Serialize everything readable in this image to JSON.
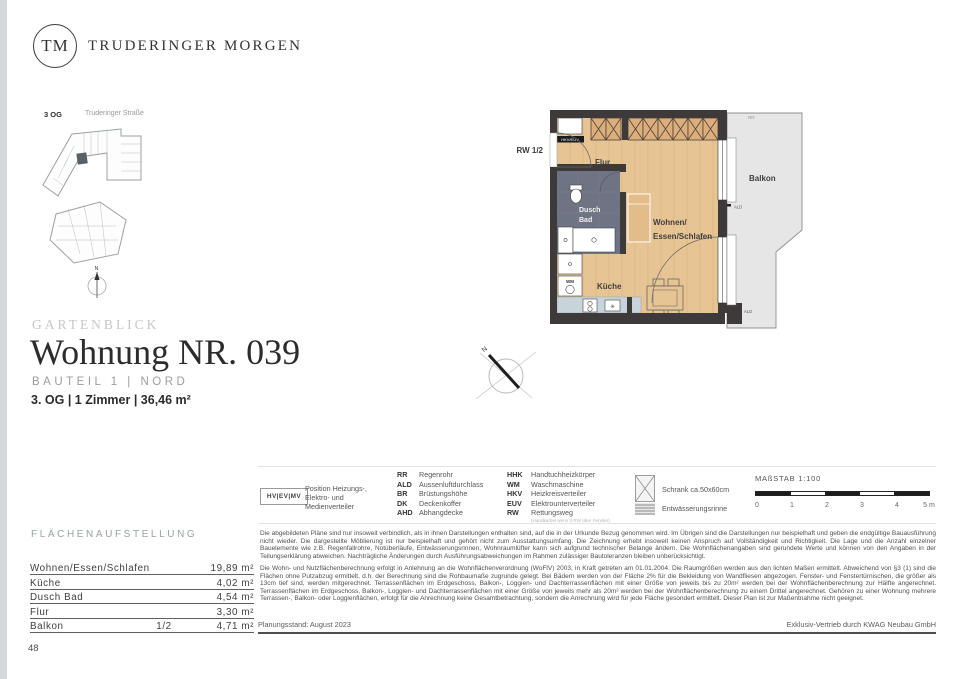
{
  "brand": {
    "initials": "TM",
    "name": "TRUDERINGER MORGEN"
  },
  "site_plan": {
    "floor": "3 OG",
    "street": "Truderinger Straße",
    "north": "N"
  },
  "floor_plan": {
    "rw": "RW 1/2",
    "flur": "Flur",
    "dusch": "Dusch",
    "bad": "Bad",
    "wohnen1": "Wohnen/",
    "wohnen2": "Essen/Schlafen",
    "kueche": "Küche",
    "balkon": "Balkon",
    "wm": "WM",
    "hkveuv": "HKV/EUV",
    "rr": "RR",
    "ald_top": "ALD",
    "ald_bottom": "ALD",
    "north": "N"
  },
  "title_block": {
    "project": "GARTENBLICK",
    "title": "Wohnung NR. 039",
    "subtitle": "BAUTEIL 1 | NORD",
    "details": "3. OG | 1 Zimmer | 36,46 m²"
  },
  "legend": {
    "hvevmv": "HV|EV|MV",
    "hvevmv_desc": "Position Heizungs-, Elektro- und Medienverteiler",
    "col1": [
      {
        "abbr": "RR",
        "label": "Regenrohr"
      },
      {
        "abbr": "ALD",
        "label": "Aussenluftdurchlass"
      },
      {
        "abbr": "BR",
        "label": "Brüstungshöhe"
      },
      {
        "abbr": "DK",
        "label": "Deckenkoffer"
      },
      {
        "abbr": "AHD",
        "label": "Abhangdecke"
      }
    ],
    "col2": [
      {
        "abbr": "HHK",
        "label": "Handtuchheizkörper"
      },
      {
        "abbr": "WM",
        "label": "Waschmaschine"
      },
      {
        "abbr": "HKV",
        "label": "Heizkreisverteiler"
      },
      {
        "abbr": "EUV",
        "label": "Elektrounterverteiler"
      },
      {
        "abbr": "RW",
        "label": "Rettungsweg",
        "note": "(Handkurbel wenn 2.RW über Fenster)"
      }
    ],
    "schrank": "Schrank ca.50x60cm",
    "rinne": "Entwässerungsrinne",
    "scale": {
      "title": "MAßSTAB 1:100",
      "ticks": [
        "0",
        "1",
        "2",
        "3",
        "4",
        "5 m"
      ]
    }
  },
  "disclaimer": {
    "p1": "Die abgebildeten Pläne sind nur insoweit verbindlich, als in ihnen Darstellungen enthalten sind, auf die in der Urkunde Bezug genommen wird. Im Übrigen sind die Darstellungen nur beispielhaft und geben die endgültige Bauausführung nicht wieder. Die dargestellte Möblierung ist nur beispielhaft und gehört nicht zum Ausstattungsumfang. Die Zeichnung erhebt insoweit keinen Anspruch auf Vollständigkeit und Richtigkeit. Die Lage und die Anzahl einzelner Bauelemente wie z.B. Regenfallrohre, Notüberläufe, Entwässerungsrinnen, Wohnraumlüfter kann sich aufgrund technischer Belange ändern. Die Wohnflächenangaben sind gerundete Werte und können von den Angaben in der Teilungserklärung abweichen. Nachträgliche Änderungen durch Ausführungsabweichungen im Rahmen zulässiger Bautoleranzen bleiben unberücksichtigt.",
    "p2": "Die Wohn- und Nutzflächenberechnung erfolgt in Anlehnung an die Wohnflächenverordnung (WoFlV) 2003, in Kraft getreten am 01.01.2004. Die Raumgrößen werden aus den lichten Maßen ermittelt. Abweichend von §3 (1) sind die Flächen ohne Putzabzug ermittelt, d.h. der Berechnung sind die Rohbaumaße zugrunde gelegt. Bei Bädern werden von der Fläche 2% für die Bekleidung von Wandfliesen abgezogen. Fenster- und Fenstertürnischen, die größer als 13cm tief sind, werden mitgerechnet. Terrassenflächen im Erdgeschoss, Balkon-, Loggien- und Dachterrassenflächen mit einer Größe von jeweils bis zu 20m² werden bei der Wohnflächenberechnung zur Hälfte angerechnet. Terrassenflächen im Erdgeschoss, Balkon-, Loggien- und Dachterrassenflächen mit einer Größe von jeweils mehr als 20m² werden bei der Wohnflächenberechnung zu einem Drittel angerechnet. Gehören zu einer Wohnung mehrere Terrassen-, Balkon- oder Loggienflächen, erfolgt für die Anrechnung keine Gesamtbetrachtung, sondern die Anrechnung wird für jede Fläche gesondert ermittelt. Dieser Plan ist zur Maßentnahme nicht geeignet."
  },
  "areas": {
    "heading": "FLÄCHENAUFSTELLUNG",
    "rows": [
      {
        "label": "Wohnen/Essen/Schlafen",
        "fraction": "",
        "value": "19,89 m²"
      },
      {
        "label": "Küche",
        "fraction": "",
        "value": "4,02 m²"
      },
      {
        "label": "Dusch Bad",
        "fraction": "",
        "value": "4,54 m²"
      },
      {
        "label": "Flur",
        "fraction": "",
        "value": "3,30 m²"
      },
      {
        "label": "Balkon",
        "fraction": "1/2",
        "value": "4,71 m²"
      }
    ]
  },
  "footer": {
    "planning": "Planungsstand: August 2023",
    "distribution": "Exklusiv-Vertrieb durch KWAG Neubau GmbH",
    "page": "48"
  },
  "colors": {
    "wood_floor": "#e7c494",
    "wall": "#3e3a39",
    "bathroom_tile": "#6f7484",
    "kitchen_counter": "#c7d5da",
    "balcony": "#e6e6e6",
    "heading_accent": "#96a1a9"
  }
}
